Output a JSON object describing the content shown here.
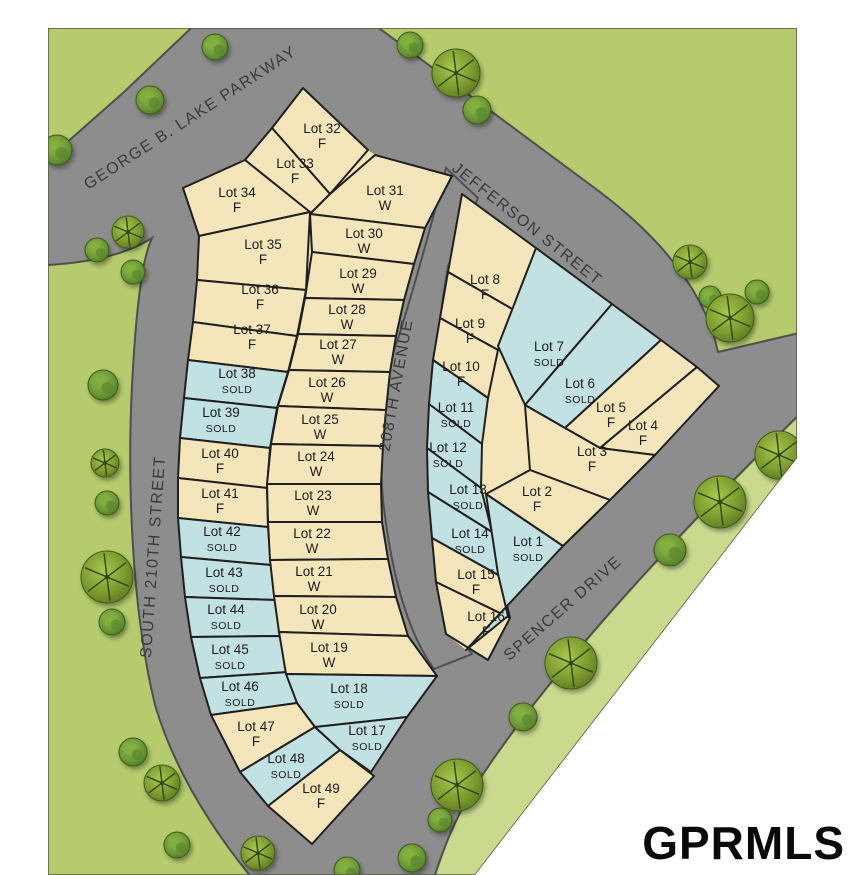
{
  "title": "Subdivision plat map",
  "watermark": {
    "text": "GPRMLS"
  },
  "colors": {
    "page_bg": "#ffffff",
    "grass": "#b5cb6e",
    "grass_strip": "#c9da8e",
    "road": "#8d8d8d",
    "road_edge": "#4f4f4f",
    "lot_available": "#f5e5ba",
    "lot_sold": "#c2e1e3",
    "lot_outline": "#1f1f1f",
    "map_border": "#555a40",
    "label_text": "#1c1c1c",
    "street_text": "#3a3a3a"
  },
  "legend_note": "F and W are availability codes shown on open lots; SOLD lots are shaded blue",
  "streets": [
    {
      "name": "GEORGE B. LAKE PARKWAY",
      "x": 193,
      "y": 122,
      "rot": -33
    },
    {
      "name": "JEFFERSON STREET",
      "x": 524,
      "y": 228,
      "rot": 38.5
    },
    {
      "name": "208TH AVENUE",
      "x": 401,
      "y": 386,
      "rot": -80
    },
    {
      "name": "SOUTH 210TH STREET",
      "x": 158,
      "y": 557,
      "rot": -86
    },
    {
      "name": "SPENCER DRIVE",
      "x": 566,
      "y": 612,
      "rot": -41
    }
  ],
  "geometry": {
    "map_clip": "48,28 797,28 797,458 475,875 48,875",
    "road_main": "M 30,175 L 124,92 L 208,12 L 240,-18 L 320,-18 L 360,14 L 600,192 Q 700,268 718,352 L 812,330 L 812,402 C 732,480 562,650 474,788 C 454,820 442,852 430,890 L 262,890 C 215,835 175,772 155,705 C 132,610 126,480 133,368 C 137,300 143,256 152,238 C 120,258 80,264 30,266 Z",
    "road_208th": "M 446,168 L 478,198 L 448,266 C 432,360 427,448 432,538 C 438,590 452,628 472,654 L 434,669 C 410,636 392,580 383,500 C 378,440 382,380 399,336 C 410,300 425,250 446,168 Z",
    "strip": "M 812,405 C 732,483 562,652 474,790 C 454,822 442,854 432,892 L 479,892 L 812,460 Z",
    "underlay_left": "183,188 245,160 272,128 303,88 368,150 375,155 452,176 425,228 414,264 404,300 396,336 390,372 386,410 383,446 381,484 382,522 388,559 396,597 408,636 437,676 407,717 371,772 312,844 268,806 240,772 211,715 200,678 191,637 185,597 181,557 178,518 178,478 180,438 184,398 188,360 193,322 197,280 199,236",
    "underlay_right": "462,194 536,248 612,304 661,340 697,367 719,386 655,455 610,500 563,546 466,650 446,634 436,582 428,492 427,448 429,404 433,360 440,318 448,266"
  },
  "lots": [
    {
      "label": "Lot 32",
      "status": "F",
      "sold": false,
      "pts": "303,88 368,150 330,194 272,128",
      "lx": 322,
      "ly": 133
    },
    {
      "label": "Lot 33",
      "status": "F",
      "sold": false,
      "pts": "245,160 272,128 330,194 310,214",
      "lx": 295,
      "ly": 168
    },
    {
      "label": "Lot 34",
      "status": "F",
      "sold": false,
      "pts": "183,188 245,160 310,212 199,236",
      "lx": 237,
      "ly": 197
    },
    {
      "label": "Lot 35",
      "status": "F",
      "sold": false,
      "pts": "199,236 310,212 306,290 197,280",
      "lx": 263,
      "ly": 249
    },
    {
      "label": "Lot 36",
      "status": "F",
      "sold": false,
      "pts": "197,280 306,290 297,336 193,322",
      "lx": 260,
      "ly": 294
    },
    {
      "label": "Lot 37",
      "status": "F",
      "sold": false,
      "pts": "193,322 297,336 288,372 188,360",
      "lx": 252,
      "ly": 334
    },
    {
      "label": "Lot 38",
      "status": "SOLD",
      "sold": true,
      "pts": "188,360 288,372 277,408 184,398",
      "lx": 237,
      "ly": 378
    },
    {
      "label": "Lot 39",
      "status": "SOLD",
      "sold": true,
      "pts": "184,398 277,408 270,448 180,438",
      "lx": 221,
      "ly": 417
    },
    {
      "label": "Lot 40",
      "status": "F",
      "sold": false,
      "pts": "180,438 270,448 267,488 178,478",
      "lx": 220,
      "ly": 458
    },
    {
      "label": "Lot 41",
      "status": "F",
      "sold": false,
      "pts": "178,478 267,488 268,527 178,518",
      "lx": 220,
      "ly": 498
    },
    {
      "label": "Lot 42",
      "status": "SOLD",
      "sold": true,
      "pts": "178,518 268,527 271,565 181,557",
      "lx": 222,
      "ly": 536
    },
    {
      "label": "Lot 43",
      "status": "SOLD",
      "sold": true,
      "pts": "181,557 271,565 275,600 185,597",
      "lx": 224,
      "ly": 577
    },
    {
      "label": "Lot 44",
      "status": "SOLD",
      "sold": true,
      "pts": "185,597 275,600 281,636 191,637",
      "lx": 226,
      "ly": 614
    },
    {
      "label": "Lot 45",
      "status": "SOLD",
      "sold": true,
      "pts": "191,637 281,636 288,672 200,678",
      "lx": 230,
      "ly": 654
    },
    {
      "label": "Lot 46",
      "status": "SOLD",
      "sold": true,
      "pts": "200,678 288,672 297,703 211,715",
      "lx": 240,
      "ly": 691
    },
    {
      "label": "Lot 47",
      "status": "F",
      "sold": false,
      "pts": "211,715 297,703 315,727 240,772",
      "lx": 256,
      "ly": 731
    },
    {
      "label": "Lot 48",
      "status": "SOLD",
      "sold": true,
      "pts": "240,772 315,727 340,750 268,806",
      "lx": 286,
      "ly": 763
    },
    {
      "label": "Lot 49",
      "status": "F",
      "sold": false,
      "pts": "268,806 340,750 374,776 312,844",
      "lx": 321,
      "ly": 793
    },
    {
      "label": "Lot 31",
      "status": "W",
      "sold": false,
      "pts": "330,194 375,155 452,176 425,228 310,214",
      "lx": 385,
      "ly": 195
    },
    {
      "label": "Lot 30",
      "status": "W",
      "sold": false,
      "pts": "310,214 425,228 414,264 312,252",
      "lx": 364,
      "ly": 238
    },
    {
      "label": "Lot 29",
      "status": "W",
      "sold": false,
      "pts": "312,252 414,264 404,300 305,298",
      "lx": 358,
      "ly": 278
    },
    {
      "label": "Lot 28",
      "status": "W",
      "sold": false,
      "pts": "305,298 404,300 396,336 298,334",
      "lx": 347,
      "ly": 314
    },
    {
      "label": "Lot 27",
      "status": "W",
      "sold": false,
      "pts": "298,334 396,336 390,372 289,370",
      "lx": 338,
      "ly": 349
    },
    {
      "label": "Lot 26",
      "status": "W",
      "sold": false,
      "pts": "289,370 390,372 386,410 278,406",
      "lx": 327,
      "ly": 387
    },
    {
      "label": "Lot 25",
      "status": "W",
      "sold": false,
      "pts": "278,406 386,410 383,446 271,444",
      "lx": 320,
      "ly": 424
    },
    {
      "label": "Lot 24",
      "status": "W",
      "sold": false,
      "pts": "271,444 383,446 381,484 267,484",
      "lx": 316,
      "ly": 461
    },
    {
      "label": "Lot 23",
      "status": "W",
      "sold": false,
      "pts": "267,484 381,484 382,522 268,522",
      "lx": 313,
      "ly": 500
    },
    {
      "label": "Lot 22",
      "status": "W",
      "sold": false,
      "pts": "268,522 382,522 388,559 270,560",
      "lx": 312,
      "ly": 538
    },
    {
      "label": "Lot 21",
      "status": "W",
      "sold": false,
      "pts": "270,560 388,559 396,597 274,596",
      "lx": 314,
      "ly": 576
    },
    {
      "label": "Lot 20",
      "status": "W",
      "sold": false,
      "pts": "274,596 396,597 408,636 279,632",
      "lx": 318,
      "ly": 614
    },
    {
      "label": "Lot 19",
      "status": "W",
      "sold": false,
      "pts": "279,632 408,636 437,676 286,674",
      "lx": 329,
      "ly": 652
    },
    {
      "label": "Lot 18",
      "status": "SOLD",
      "sold": true,
      "pts": "286,674 437,676 407,717 315,727 297,703",
      "lx": 349,
      "ly": 693
    },
    {
      "label": "Lot 17",
      "status": "SOLD",
      "sold": true,
      "pts": "315,727 407,717 371,772 340,750",
      "lx": 367,
      "ly": 735
    },
    {
      "label": "Lot 8",
      "status": "F",
      "sold": false,
      "pts": "462,194 536,248 514,310 448,272",
      "lx": 485,
      "ly": 284
    },
    {
      "label": "Lot 9",
      "status": "F",
      "sold": false,
      "pts": "448,272 514,310 498,350 440,318",
      "lx": 470,
      "ly": 328
    },
    {
      "label": "Lot 10",
      "status": "F",
      "sold": false,
      "pts": "440,318 498,350 488,398 433,360",
      "lx": 461,
      "ly": 371
    },
    {
      "label": "Lot 11",
      "status": "SOLD",
      "sold": true,
      "pts": "433,360 488,398 482,444 429,404",
      "lx": 456,
      "ly": 412
    },
    {
      "label": "Lot 12",
      "status": "SOLD",
      "sold": true,
      "pts": "429,404 482,444 481,488 427,448",
      "lx": 448,
      "ly": 452
    },
    {
      "label": "Lot 13",
      "status": "SOLD",
      "sold": true,
      "pts": "427,448 481,488 492,532 428,492",
      "lx": 468,
      "ly": 494
    },
    {
      "label": "Lot 14",
      "status": "SOLD",
      "sold": true,
      "pts": "428,492 492,532 500,576 432,538",
      "lx": 470,
      "ly": 538
    },
    {
      "label": "Lot 15",
      "status": "F",
      "sold": false,
      "pts": "432,538 500,576 510,618 436,582",
      "lx": 476,
      "ly": 579
    },
    {
      "label": "Lot 16",
      "status": "F",
      "sold": false,
      "pts": "436,582 510,618 488,660 446,634",
      "lx": 486,
      "ly": 621
    },
    {
      "label": "Lot 7",
      "status": "SOLD",
      "sold": true,
      "pts": "536,248 612,304 525,405 498,346",
      "lx": 549,
      "ly": 351
    },
    {
      "label": "Lot 6",
      "status": "SOLD",
      "sold": true,
      "pts": "612,304 661,340 565,428 525,405",
      "lx": 580,
      "ly": 388
    },
    {
      "label": "Lot 5",
      "status": "F",
      "sold": false,
      "pts": "661,340 697,367 600,448 565,428",
      "lx": 611,
      "ly": 412
    },
    {
      "label": "Lot 4",
      "status": "F",
      "sold": false,
      "pts": "697,367 719,386 655,455 600,448",
      "lx": 643,
      "ly": 430
    },
    {
      "label": "Lot 3",
      "status": "F",
      "sold": false,
      "pts": "525,405 565,428 600,448 655,455 610,500 530,470",
      "lx": 592,
      "ly": 456
    },
    {
      "label": "Lot 2",
      "status": "F",
      "sold": false,
      "pts": "530,470 610,500 563,546 486,494",
      "lx": 537,
      "ly": 496
    },
    {
      "label": "Lot 1",
      "status": "SOLD",
      "sold": true,
      "pts": "486,494 563,546 466,650 508,616 498,574",
      "lx": 528,
      "ly": 546
    }
  ],
  "trees": [
    {
      "x": 57,
      "y": 150,
      "r": 15,
      "type": "bush"
    },
    {
      "x": 150,
      "y": 100,
      "r": 14,
      "type": "bush"
    },
    {
      "x": 215,
      "y": 47,
      "r": 13,
      "type": "bush"
    },
    {
      "x": 410,
      "y": 45,
      "r": 13,
      "type": "bush"
    },
    {
      "x": 456,
      "y": 73,
      "r": 24,
      "type": "pin"
    },
    {
      "x": 477,
      "y": 110,
      "r": 14,
      "type": "bush"
    },
    {
      "x": 690,
      "y": 262,
      "r": 17,
      "type": "pin"
    },
    {
      "x": 710,
      "y": 297,
      "r": 11,
      "type": "bush"
    },
    {
      "x": 730,
      "y": 318,
      "r": 24,
      "type": "pin"
    },
    {
      "x": 757,
      "y": 292,
      "r": 12,
      "type": "bush"
    },
    {
      "x": 128,
      "y": 232,
      "r": 16,
      "type": "pin"
    },
    {
      "x": 97,
      "y": 250,
      "r": 12,
      "type": "bush"
    },
    {
      "x": 133,
      "y": 272,
      "r": 12,
      "type": "bush"
    },
    {
      "x": 103,
      "y": 385,
      "r": 15,
      "type": "bush"
    },
    {
      "x": 105,
      "y": 463,
      "r": 14,
      "type": "pin"
    },
    {
      "x": 107,
      "y": 503,
      "r": 12,
      "type": "bush"
    },
    {
      "x": 107,
      "y": 577,
      "r": 26,
      "type": "pin"
    },
    {
      "x": 112,
      "y": 622,
      "r": 13,
      "type": "bush"
    },
    {
      "x": 133,
      "y": 752,
      "r": 14,
      "type": "bush"
    },
    {
      "x": 162,
      "y": 783,
      "r": 18,
      "type": "pin"
    },
    {
      "x": 177,
      "y": 845,
      "r": 13,
      "type": "bush"
    },
    {
      "x": 258,
      "y": 853,
      "r": 17,
      "type": "pin"
    },
    {
      "x": 347,
      "y": 870,
      "r": 13,
      "type": "bush"
    },
    {
      "x": 412,
      "y": 858,
      "r": 14,
      "type": "bush"
    },
    {
      "x": 779,
      "y": 455,
      "r": 24,
      "type": "pin"
    },
    {
      "x": 720,
      "y": 502,
      "r": 26,
      "type": "pin"
    },
    {
      "x": 670,
      "y": 550,
      "r": 16,
      "type": "bush"
    },
    {
      "x": 571,
      "y": 663,
      "r": 26,
      "type": "pin"
    },
    {
      "x": 523,
      "y": 717,
      "r": 14,
      "type": "bush"
    },
    {
      "x": 457,
      "y": 785,
      "r": 26,
      "type": "pin"
    },
    {
      "x": 440,
      "y": 820,
      "r": 12,
      "type": "bush"
    },
    {
      "x": 520,
      "y": 858,
      "r": 12,
      "type": "bush"
    }
  ]
}
